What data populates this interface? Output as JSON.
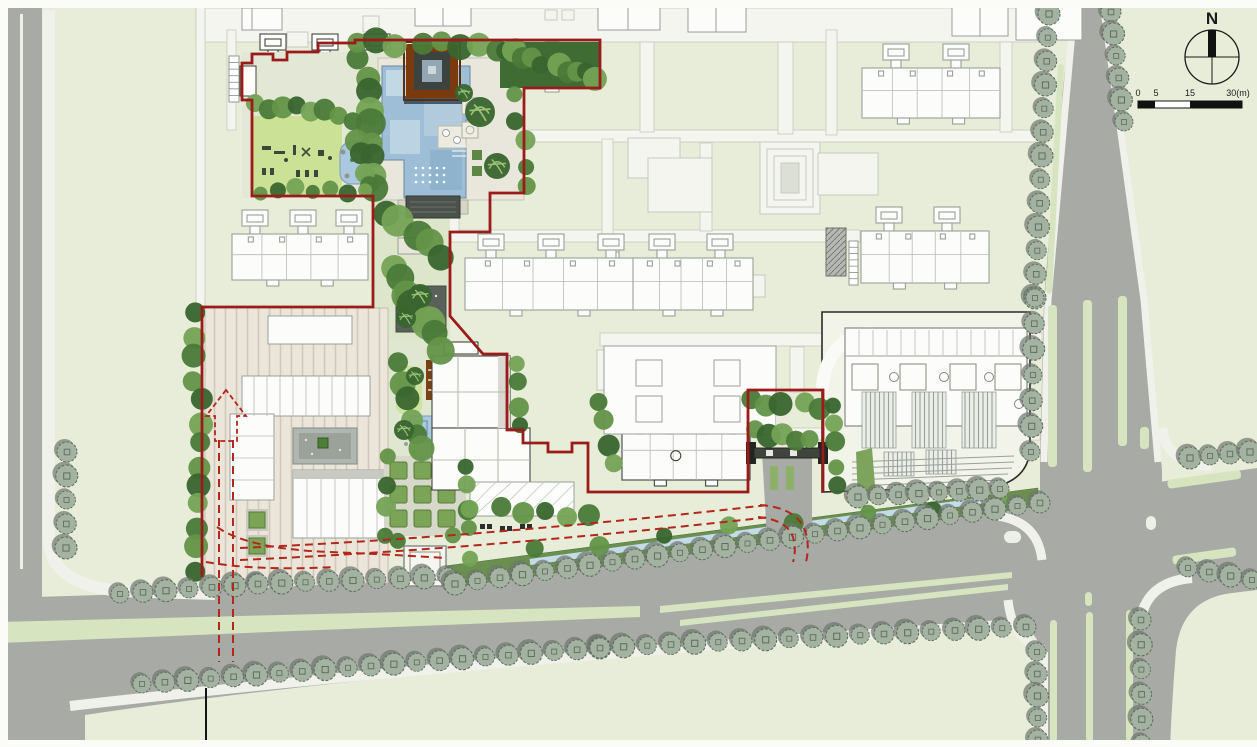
{
  "compass": {
    "label": "N"
  },
  "scale_bar": {
    "ticks": [
      "0",
      "5",
      "15",
      "30(m)"
    ]
  },
  "colors": {
    "lawn": "#e7edd8",
    "playLawn": "#cbe196",
    "brightLawn": "#cde39e",
    "road": "#a8aba5",
    "sidewalk": "#f0f1ea",
    "median": "#d7e4c0",
    "path": "#f4f5ee",
    "pathEdge": "#c6cabf",
    "streetTree": "#a4b2a2",
    "streetTreeEdge": "#5f6d5f",
    "streetTreeShadow": "#6e766e",
    "lush1": "#4a7a38",
    "lush2": "#639448",
    "lush3": "#39652e",
    "lush4": "#74a355",
    "hedge": "#7ca457",
    "hedgeEdge": "#567a38",
    "hedgeBand": "#6a8f4f",
    "pool": "#9dbed6",
    "poolPanel": "#c3d8e5",
    "poolPanel2": "#b2cbdc",
    "poolDark": "#2f4859",
    "pond": "#aac9e0",
    "channel": "#c5dbe7",
    "deck": "#e9e7db",
    "pavilionBrown": "#7a3a0e",
    "pavilionRing": "#3c423e",
    "pavilionInner": "#93a6b2",
    "woodBrown": "#7a3f12",
    "plaza": "#ebe6d9",
    "plazaStripe": "#cfc9ba",
    "court": "#b0b6b0",
    "building": "#fcfcfa",
    "buildingStroke": "#9aa09a",
    "buildingStrokeDark": "#43463f",
    "boundaryRed": "#9b1b1b",
    "routeRed": "#b3271d",
    "ink": "#1b1b1b"
  }
}
